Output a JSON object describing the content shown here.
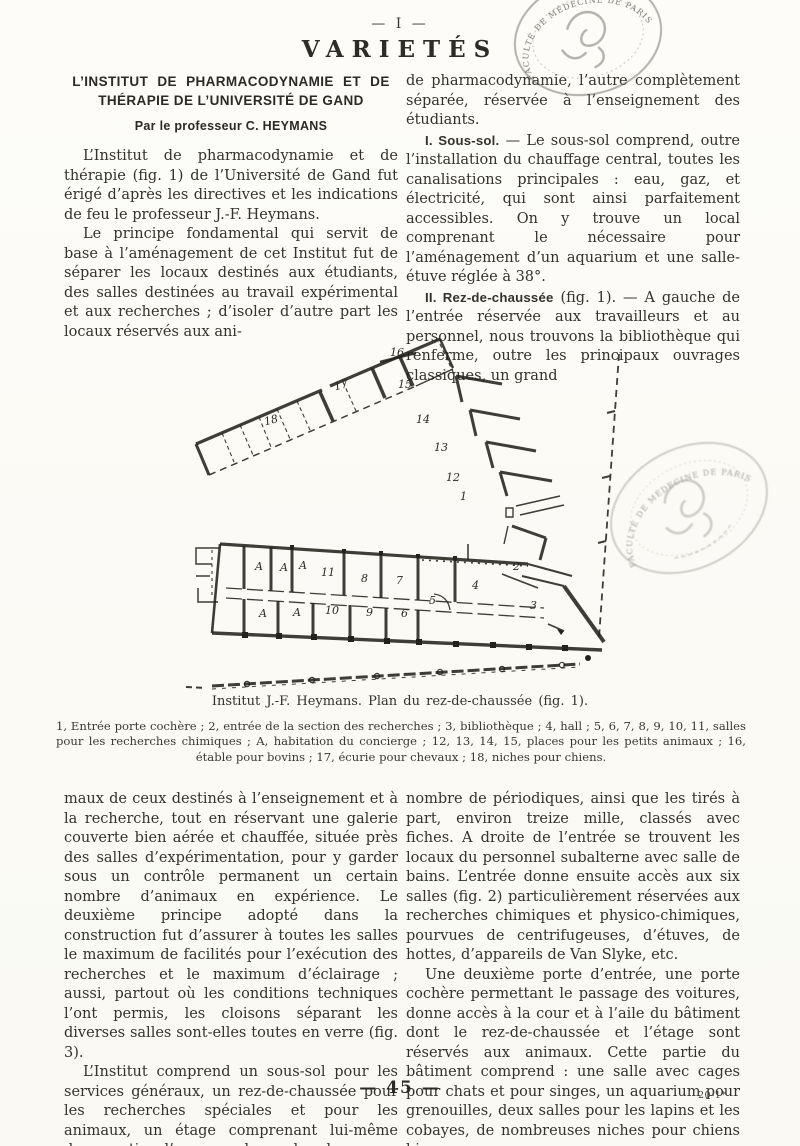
{
  "page": {
    "folio": "— I —",
    "rubric": "VARIETÉS",
    "page_number": "— 45 —",
    "signature": "20-1*"
  },
  "article": {
    "title_line1": "L’INSTITUT DE PHARMACODYNAMIE ET DE",
    "title_line2": "THÉRAPIE DE L’UNIVERSITÉ DE GAND",
    "byline": "Par le professeur C. HEYMANS"
  },
  "col_top_left": {
    "p1": "L’Institut de pharmacodynamie et de thérapie (fig. 1) de l’Université de Gand fut érigé d’après les directives et les indications de feu le professeur J.-F. Heymans.",
    "p2": "Le principe fondamental qui servit de base à l’aménagement de cet Institut fut de séparer les locaux destinés aux étudiants, des salles destinées au travail expérimental et aux recherches ; d’isoler d’autre part les locaux réservés aux ani-"
  },
  "col_top_right": {
    "p0": "de pharmacodynamie, l’autre complètement séparée, réservée à l’enseignement des étudiants.",
    "p1_head": "I. Sous-sol.",
    "p1_rest": " — Le sous-sol comprend, outre l’installation du chauffage central, toutes les canalisations principales : eau, gaz, et électricité, qui sont ainsi parfaitement accessibles. On y trouve un local comprenant le nécessaire pour l’aménagement d’un aquarium et une salle-étuve réglée à 38°.",
    "p2_head": "II. Rez-de-chaussée",
    "p2_rest": " (fig. 1). — A gauche de l’entrée réservée aux travailleurs et au personnel, nous trouvons la bibliothèque qui renferme, outre les principaux ouvrages classiques, un grand"
  },
  "figure": {
    "caption": "Institut J.-F. Heymans. Plan du rez-de-chaussée (fig. 1).",
    "legend": "1, Entrée porte cochère ; 2, entrée de la section des recherches ; 3, bibliothèque ; 4, hall ; 5, 6, 7, 8, 9, 10, 11, salles pour les recherches chimiques ; A, habitation du concierge ; 12, 13, 14, 15, places pour les petits animaux ; 16, étable pour bovins ; 17, écurie pour chevaux ; 18, niches pour chiens.",
    "rooms": {
      "r16": "16",
      "r15": "15",
      "r14": "14",
      "r13": "13",
      "r12": "12",
      "r1": "1",
      "r17": "17",
      "r18": "18",
      "a1": "A",
      "a2": "A",
      "a3": "A",
      "r11": "11",
      "r8": "8",
      "r7": "7",
      "r2": "2",
      "r4": "4",
      "r5": "5",
      "r3": "3",
      "a4": "A",
      "a5": "A",
      "r10": "10",
      "r9": "9",
      "r6": "6"
    }
  },
  "col_bottom_left": {
    "p0": "maux de ceux destinés à l’enseignement et à la recherche, tout en réservant une galerie couverte bien aérée et chauffée, située près des salles d’expérimentation, pour y garder sous un contrôle permanent un certain nombre d’animaux en expérience. Le deuxième principe adopté dans la construction fut d’assurer à toutes les salles le maximum de facilités pour l’exécution des recherches et le maximum d’éclairage ; aussi, partout où les conditions techniques l’ont permis, les cloisons séparant les diverses salles sont-elles toutes en verre (fig. 3).",
    "p1": "L’Institut comprend un sous-sol pour les services généraux, un rez-de-chaussée pour les recherches spéciales et pour les animaux, un étage comprenant lui-même deux parties, l’une pour les recherches"
  },
  "col_bottom_right": {
    "p0": "nombre de périodiques, ainsi que les tirés à part, environ treize mille, classés avec fiches. A droite de l’entrée se trouvent les locaux du personnel subalterne avec salle de bains. L’entrée donne ensuite accès aux six salles (fig. 2) particulièrement réservées aux recherches chimiques et physico-chimiques, pourvues de centrifugeuses, d’étuves, de hottes, d’appareils de Van Slyke, etc.",
    "p1": "Une deuxième porte d’entrée, une porte cochère permettant le passage des voitures, donne accès à la cour et à l’aile du bâtiment dont le rez-de-chaussée et l’étage sont réservés aux animaux. Cette partie du bâtiment comprend : une salle avec cages pour chats et pour singes, un aquarium pour grenouilles, deux salles pour les lapins et les cobayes, de nombreuses niches pour chiens bien"
  },
  "stamps": {
    "text": "FACULTÉ DE MÉDECINE DE PARIS"
  }
}
